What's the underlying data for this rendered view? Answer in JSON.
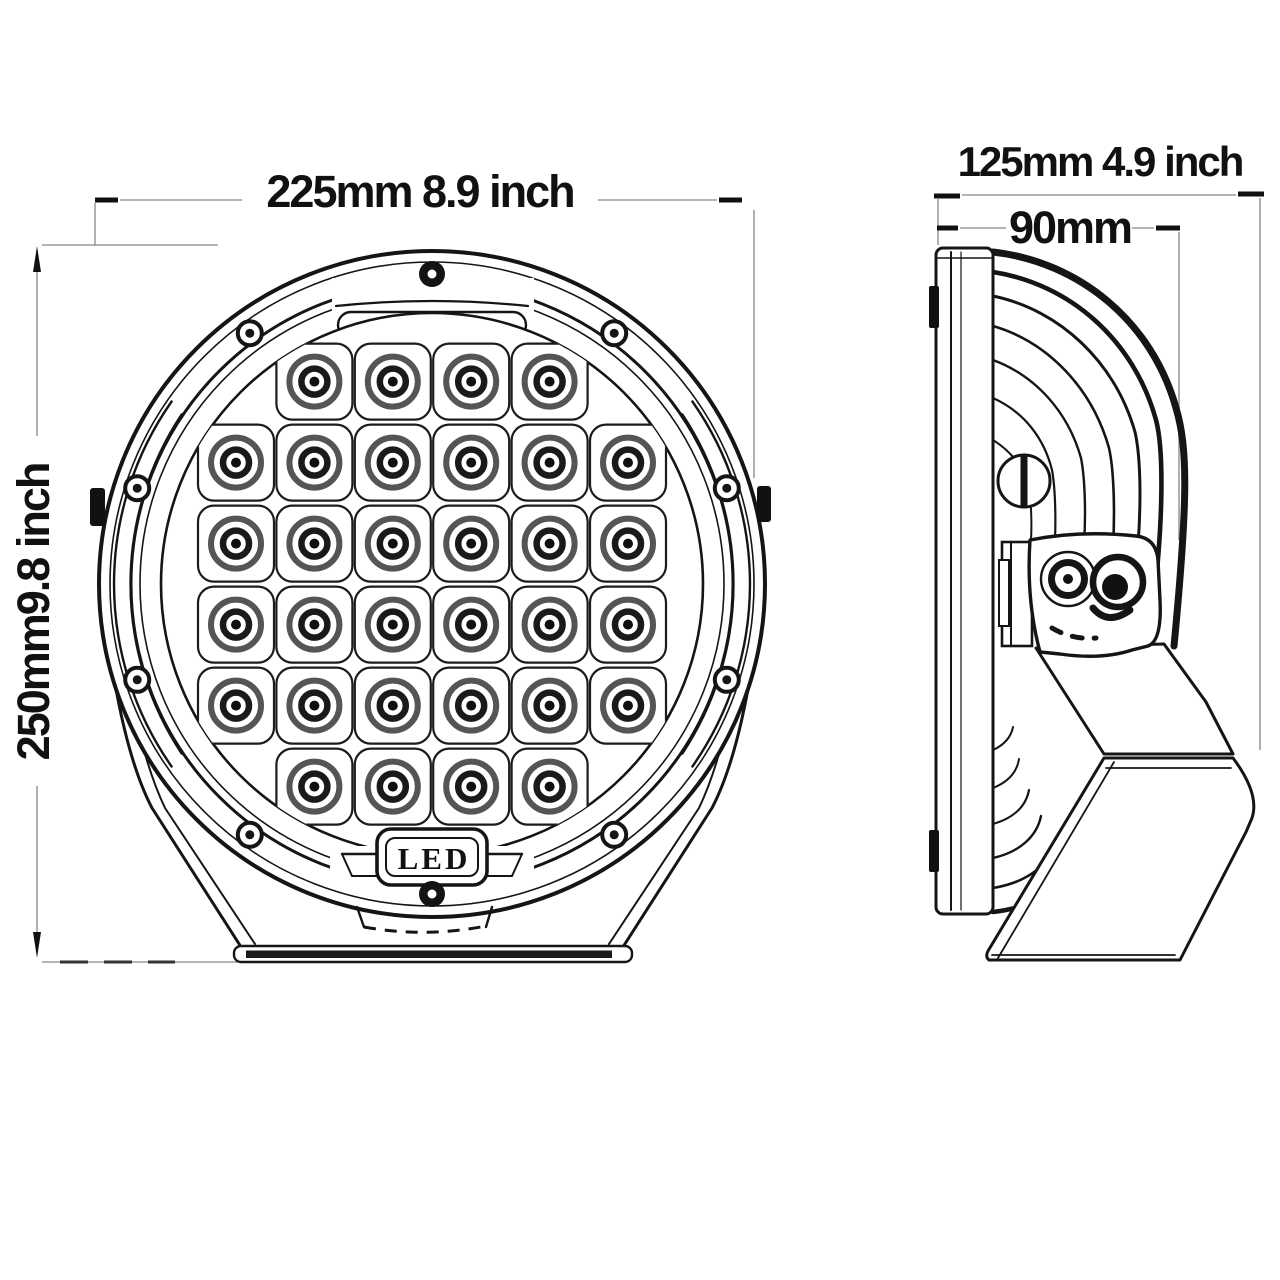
{
  "colors": {
    "background": "#ffffff",
    "line": "#151515",
    "dim_line": "#9c9c9c"
  },
  "front_view": {
    "width_dimension": "225mm 8.9 inch",
    "height_dimension": "250mm9.8 inch",
    "badge": "LED",
    "screw_count": 10,
    "led_grid": {
      "rows": [
        4,
        6,
        6,
        6,
        6,
        4
      ],
      "total_leds": 32
    }
  },
  "side_view": {
    "overall_depth_dimension": "125mm 4.9 inch",
    "housing_depth_dimension": "90mm"
  }
}
